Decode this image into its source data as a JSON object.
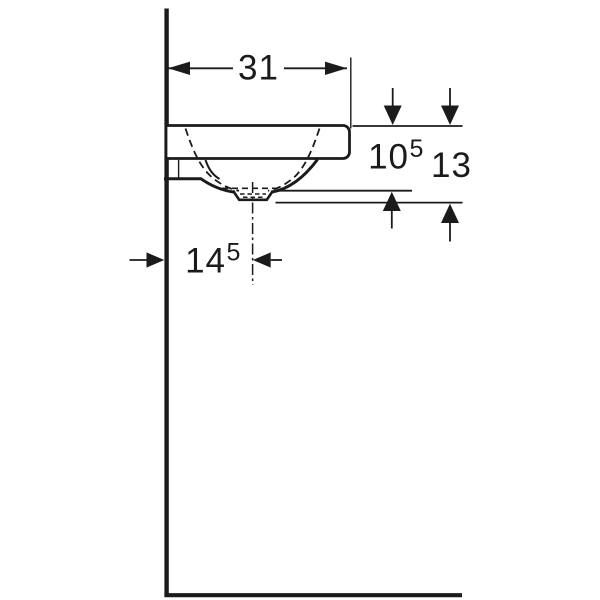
{
  "drawing": {
    "description": "Washbasin side elevation technical dimension drawing",
    "background_color": "#ffffff",
    "line_color": "#1b1b1b",
    "labels": {
      "width": {
        "value": "31",
        "sup": ""
      },
      "depth_to_bowl_bottom": {
        "value": "10",
        "sup": "5"
      },
      "depth_total": {
        "value": "13",
        "sup": ""
      },
      "drain_offset_from_wall": {
        "value": "14",
        "sup": "5"
      }
    }
  }
}
